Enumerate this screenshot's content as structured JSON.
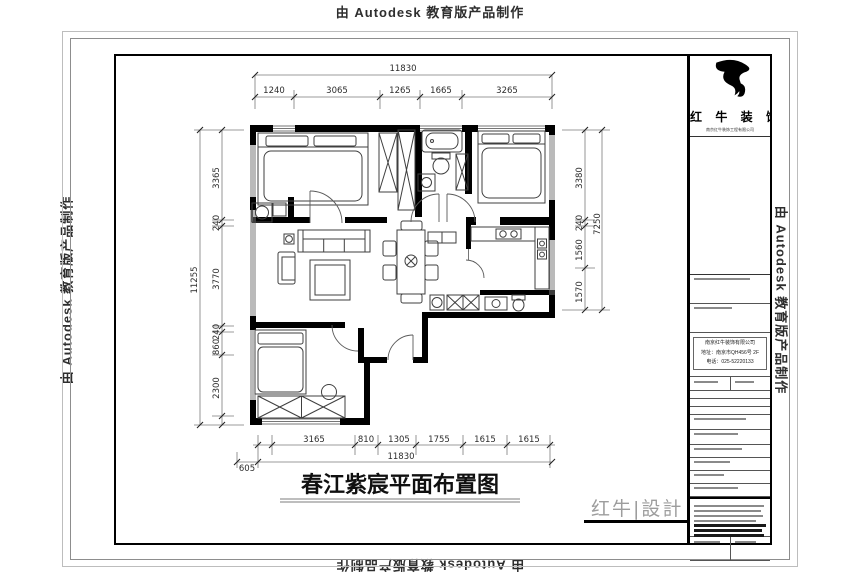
{
  "watermarks": {
    "autodesk": "由 Autodesk 教育版产品制作"
  },
  "drawing": {
    "title": "春江紫宸平面布置图",
    "design_mark": "红牛|設計"
  },
  "titleblock": {
    "brand": "红 牛 装 饰",
    "brand_sub": "南京红牛装饰工程有限公司",
    "company_lines": {
      "0": "南京红牛装饰有限公司",
      "1": "地址：南京市QH456号 2F",
      "2": "电话：025-52220133"
    }
  },
  "plan": {
    "dims": {
      "top_total": "11830",
      "top_segments": [
        "1240",
        "3065",
        "1265",
        "1665",
        "3265"
      ],
      "left_total": "11255",
      "left_segments": [
        "3365",
        "240",
        "3770",
        "240",
        "860",
        "2300"
      ],
      "right_total": "7250",
      "right_segments": [
        "3380",
        "240",
        "1560",
        "1570"
      ],
      "bottom_total": "11830",
      "bottom_offset": "605",
      "bottom_segments": [
        "3165",
        "810",
        "1305",
        "1755",
        "1615",
        "1615"
      ]
    }
  }
}
